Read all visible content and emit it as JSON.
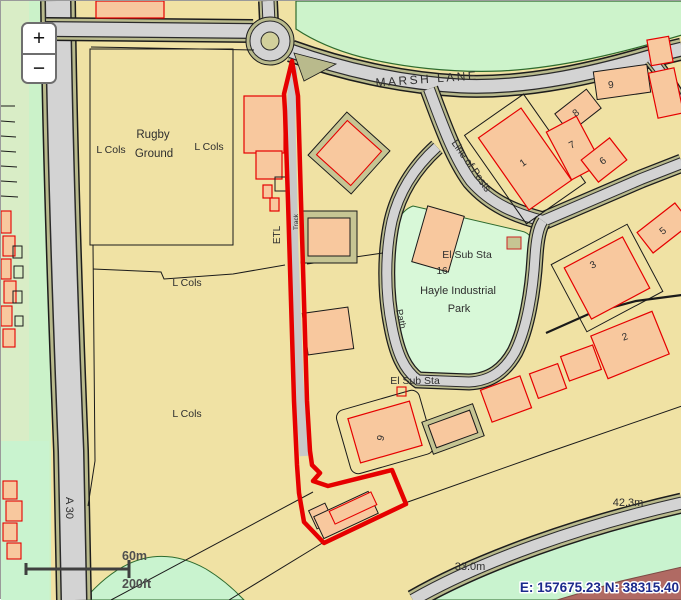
{
  "controls": {
    "zoom_in": "+",
    "zoom_out": "−"
  },
  "scale_bar": {
    "metric": "60m",
    "imperial": "200ft"
  },
  "status": {
    "coordinates": "E: 157675.23 N: 38315.40"
  },
  "map_labels": {
    "road_marsh_lane": "MARSH LANE",
    "road_a30": "A 30",
    "rugby_line1": "Rugby",
    "rugby_line2": "Ground",
    "l_cols": "L Cols",
    "etl": "ETL",
    "track": "Track",
    "line_of_posts": "Line of Posts",
    "el_sub_sta": "El Sub Sta",
    "hayle_line1": "Hayle Industrial",
    "hayle_line2": "Park",
    "path": "Path",
    "plot_16": "16",
    "height_1": "42.3m",
    "height_2": "33.0m",
    "bld": {
      "n1": "1",
      "n2": "2",
      "n3": "3",
      "n5": "5",
      "n6": "6",
      "n7": "7",
      "n8": "8",
      "n9": "9"
    }
  },
  "colors": {
    "selection_boundary": "#e60000",
    "building_fill": "#f8c89e",
    "road_fill": "#d3d3d3",
    "verge_fill": "#b9ba8c",
    "land_fill": "#f0e2a4",
    "field_green": "#cdf3cb",
    "park_green": "#d8f8d8",
    "coordinate_text": "#1b2a8c"
  }
}
